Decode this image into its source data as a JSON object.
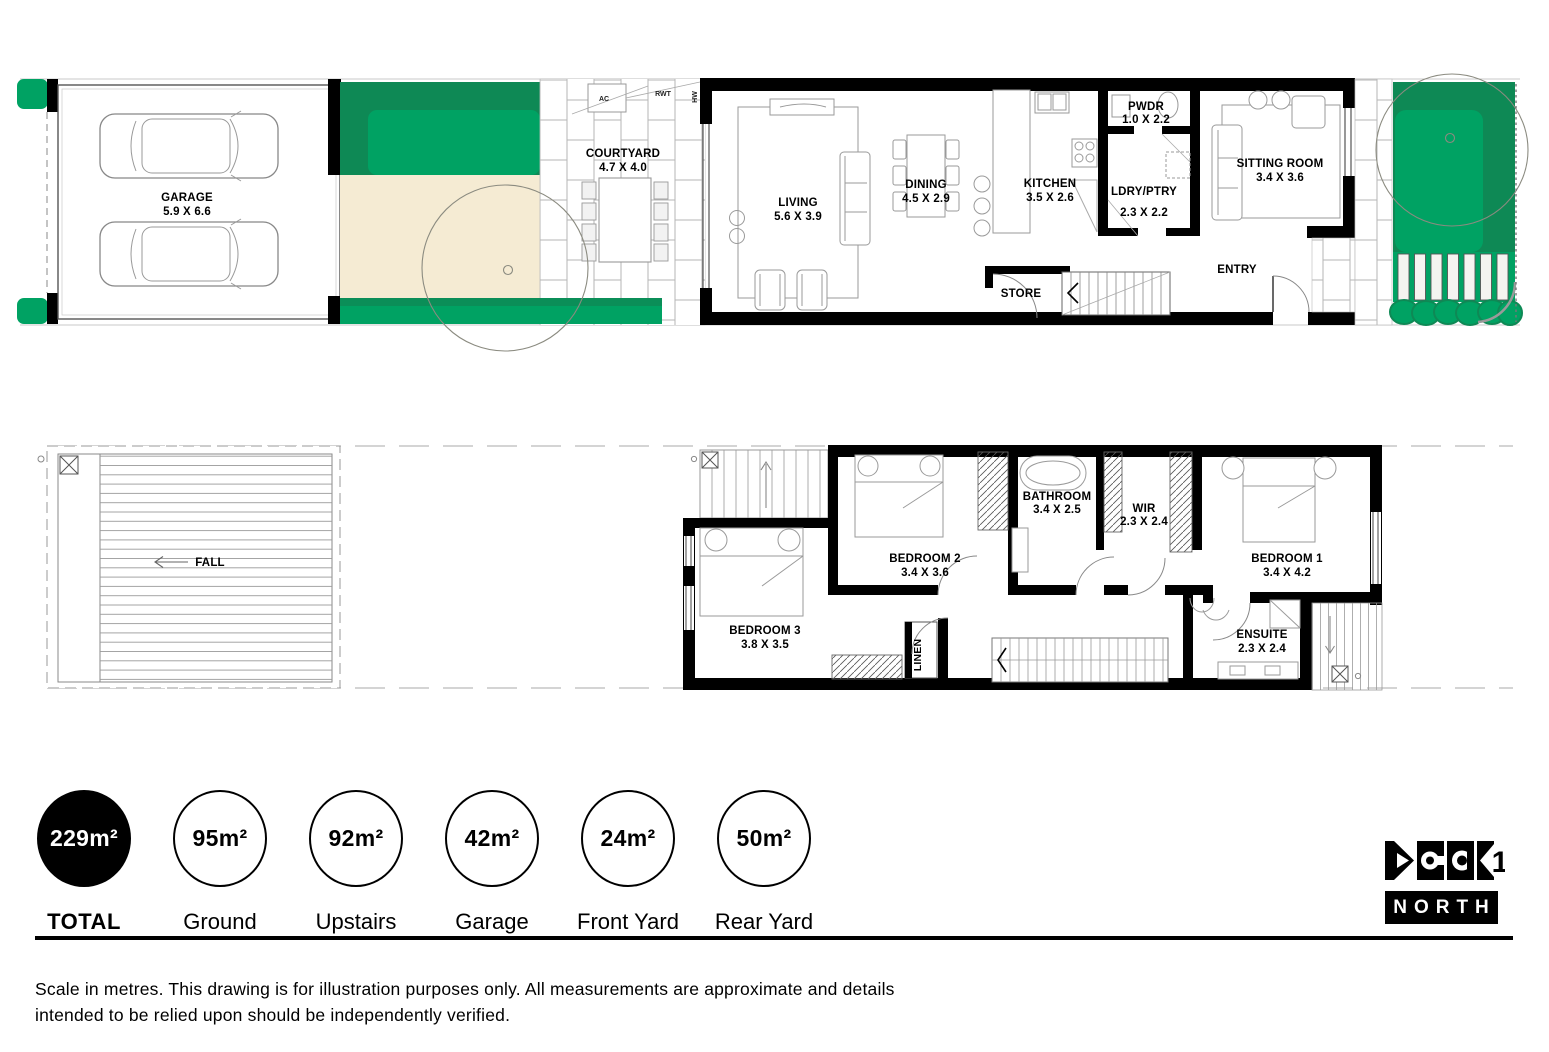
{
  "ground": {
    "rooms": [
      {
        "name": "GARAGE",
        "dims": "5.9 X 6.6"
      },
      {
        "name": "COURTYARD",
        "dims": "4.7 X 4.0"
      },
      {
        "name": "LIVING",
        "dims": "5.6 X 3.9"
      },
      {
        "name": "DINING",
        "dims": "4.5 X 2.9"
      },
      {
        "name": "KITCHEN",
        "dims": "3.5 X 2.6"
      },
      {
        "name": "PWDR",
        "dims": "1.0 X 2.2"
      },
      {
        "name": "LDRY/PTRY",
        "dims": "2.3 X 2.2"
      },
      {
        "name": "SITTING ROOM",
        "dims": "3.4 X 3.6"
      },
      {
        "name": "ENTRY",
        "dims": ""
      },
      {
        "name": "STORE",
        "dims": ""
      }
    ],
    "small_labels": [
      {
        "label": "AC"
      },
      {
        "label": "RWT"
      },
      {
        "label": "HW"
      }
    ]
  },
  "upper": {
    "roof_label": "FALL",
    "rooms": [
      {
        "name": "BEDROOM 2",
        "dims": "3.4 X 3.6"
      },
      {
        "name": "BATHROOM",
        "dims": "3.4 X 2.5"
      },
      {
        "name": "WIR",
        "dims": "2.3 X 2.4"
      },
      {
        "name": "BEDROOM 1",
        "dims": "3.4 X 4.2"
      },
      {
        "name": "BEDROOM 3",
        "dims": "3.8 X 3.5"
      },
      {
        "name": "ENSUITE",
        "dims": "2.3 X 2.4"
      },
      {
        "name": "LINEN",
        "dims": ""
      }
    ]
  },
  "area_badges": [
    {
      "value": "229m²",
      "label": "TOTAL",
      "filled": true
    },
    {
      "value": "95m²",
      "label": "Ground",
      "filled": false
    },
    {
      "value": "92m²",
      "label": "Upstairs",
      "filled": false
    },
    {
      "value": "42m²",
      "label": "Garage",
      "filled": false
    },
    {
      "value": "24m²",
      "label": "Front Yard",
      "filled": false
    },
    {
      "value": "50m²",
      "label": "Rear Yard",
      "filled": false
    }
  ],
  "logo": {
    "digit": "1",
    "text": "NORTH"
  },
  "disclaimer": "Scale in metres. This drawing is for illustration purposes only. All measurements are approximate and details intended to be relied upon should be independently verified.",
  "colors": {
    "lawn_green": "#00a263",
    "lawn_green_dark": "#0e8955",
    "sand_beige": "#f5ebd3",
    "wall_black": "#000000"
  }
}
